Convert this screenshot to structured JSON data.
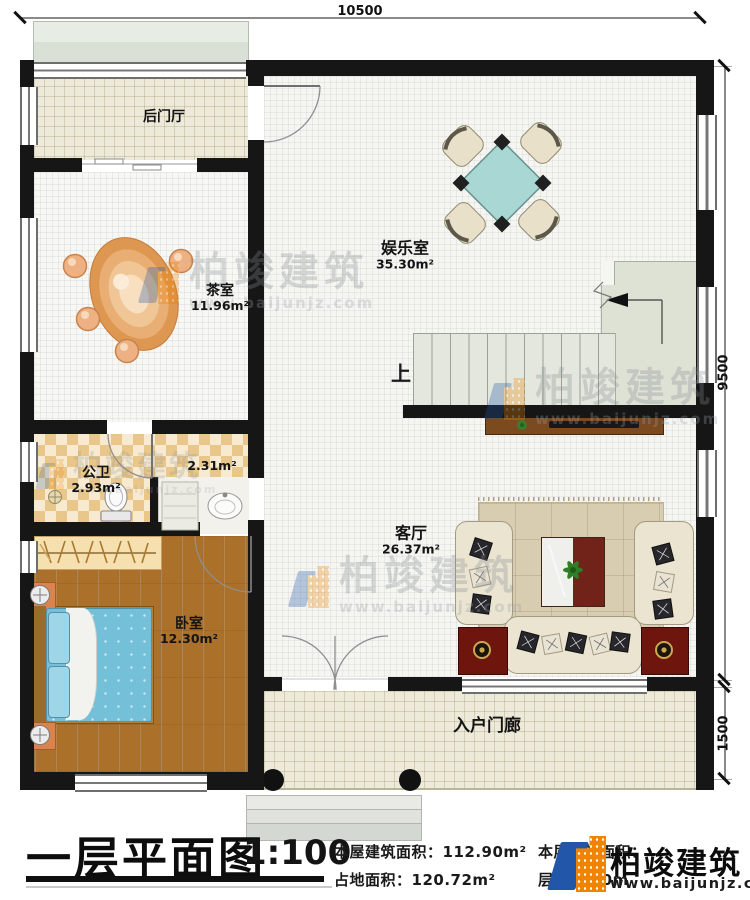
{
  "dimensions": {
    "top": "10500",
    "right": "9500",
    "porch": "1500"
  },
  "rooms": {
    "back_hall": {
      "name": "后门厅"
    },
    "tea_room": {
      "name": "茶室",
      "area": "11.96m²"
    },
    "entertainment": {
      "name": "娱乐室",
      "area": "35.30m²"
    },
    "bathroom": {
      "name": "公卫",
      "area": "2.93m²"
    },
    "vanity": {
      "area": "2.31m²"
    },
    "bedroom": {
      "name": "卧室",
      "area": "12.30m²"
    },
    "living_room": {
      "name": "客厅",
      "area": "26.37m²"
    },
    "entry_porch": {
      "name": "入户门廊"
    }
  },
  "stairs": {
    "up_label": "上"
  },
  "title_block": {
    "title": "一层平面图",
    "scale": "1:100",
    "stats": [
      {
        "label": "本屋建筑面积：",
        "value": "112.90m²"
      },
      {
        "label": "占地面积：",
        "value": "120.72m²"
      },
      {
        "label": "本层建筑面积：",
        "value": ""
      },
      {
        "label": "层高：",
        "value": "3.0m"
      }
    ]
  },
  "brand": {
    "name": "柏竣建筑",
    "url": "www.baijunjz.com"
  },
  "watermark": {
    "name": "柏竣建筑",
    "url": "www.baijunjz.com"
  },
  "colors": {
    "wall": "#161616",
    "game_table": "#a9d7d4",
    "tea_table": "#dd9751",
    "brand_blue": "#2156a8",
    "brand_orange": "#f08300"
  }
}
